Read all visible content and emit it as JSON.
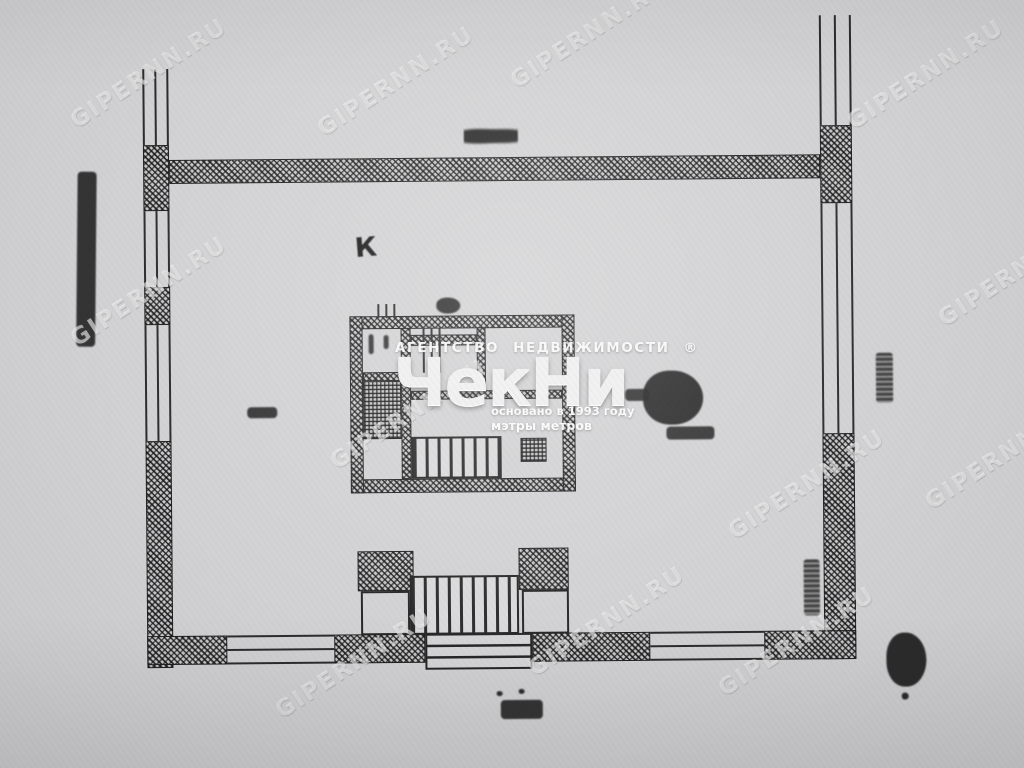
{
  "watermark": {
    "text": "GIPERNN.RU"
  },
  "agency_logo": {
    "top_left": "АГЕНТСТВО",
    "top_right": "НЕДВИЖИМОСТИ",
    "registered_mark": "®",
    "brand": "ЧекНи",
    "founded_line": "основано в 1993 году",
    "slogan": "мэтры метров"
  },
  "plan_labels": {
    "room_letter": "К"
  },
  "colors": {
    "paper": "#d2d2d4",
    "ink": "#262626",
    "watermark": "#ffffff"
  }
}
